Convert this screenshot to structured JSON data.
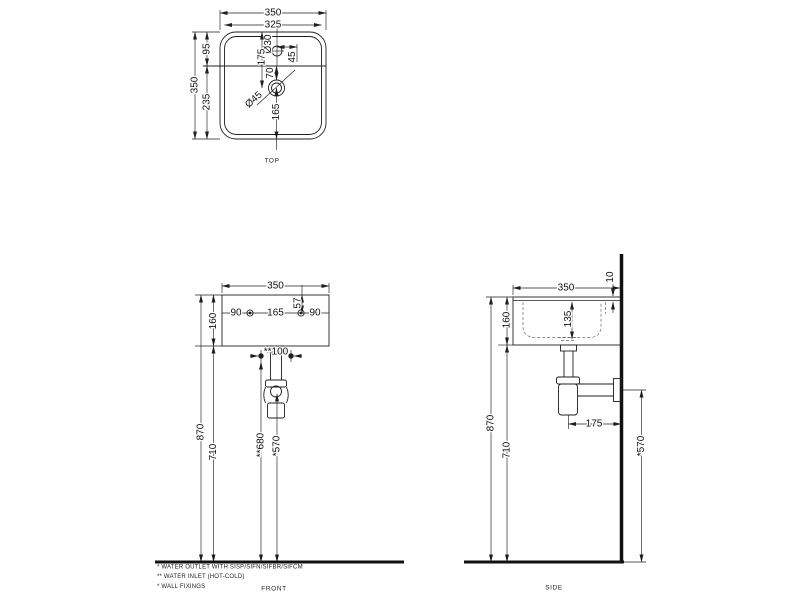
{
  "drawing": {
    "background": "#ffffff",
    "line_color": "#1f1f1f"
  },
  "views": {
    "top": {
      "label": "TOP",
      "dims": {
        "width_overall": "350",
        "width_inner": "325",
        "depth_overall": "350",
        "rear_to_ledge": "95",
        "ledge_to_front": "235",
        "rear_to_drain": "175",
        "faucet_hole_dia": "Ø30",
        "faucet_offset": "45",
        "ledge_to_drain": "70",
        "drain_dia": "Ø45",
        "drain_to_front": "165"
      }
    },
    "front": {
      "label": "FRONT",
      "dims": {
        "width": "350",
        "fix_left": "90",
        "fix_span": "165",
        "fix_right": "90",
        "rim_to_fix": "57",
        "basin_height": "160",
        "rim_height": "870",
        "underside_height": "710",
        "inlet_spacing": "**100",
        "inlet_height": "**680",
        "outlet_height": "*570"
      }
    },
    "side": {
      "label": "SIDE",
      "dims": {
        "depth": "350",
        "rear_gap": "10",
        "basin_height": "160",
        "bowl_depth": "135",
        "rim_height": "870",
        "underside_height": "710",
        "trap_to_wall": "175",
        "outlet_height": "*570"
      }
    }
  },
  "notes": [
    "*  WATER OUTLET WITH SISP/SIFN/SIFBR/SIFCM",
    "** WATER INLET  (HOT-COLD)",
    "*  WALL FIXINGS"
  ]
}
